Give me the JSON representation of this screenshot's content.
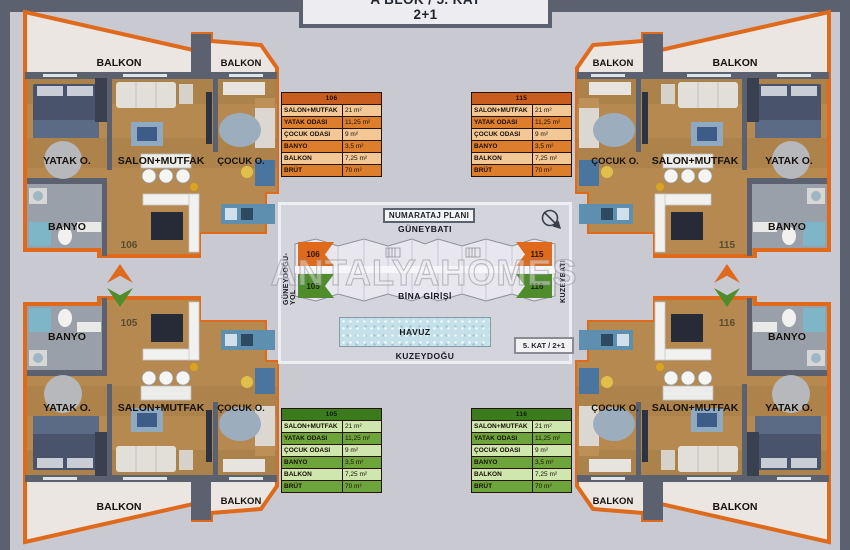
{
  "header": {
    "title_line1": "A BLOK / 5. KAT",
    "title_line2": "2+1"
  },
  "watermark": "ANTALYAHOMES",
  "colors": {
    "orange": "#E06A1C",
    "green": "#4F8D2C",
    "slate": "#5C6170",
    "pool_blue": "#C4E1E9"
  },
  "site_plan": {
    "title": "NUMARATAJ PLANI",
    "dir_top": "GÜNEYBATI",
    "dir_bottom": "KUZEYDOĞU",
    "dir_left": "GÜNEYDOĞU-YOL",
    "dir_right": "KUZEYBATI",
    "entrance": "BİNA GİRİŞİ",
    "pool": "HAVUZ",
    "floor_badge": "5. KAT / 2+1",
    "units": {
      "tl": "106",
      "bl": "105",
      "tr": "115",
      "br": "116"
    }
  },
  "apartments": {
    "a106": {
      "number": "106",
      "balkon_wide": "BALKON",
      "balkon_small": "BALKON",
      "bedroom": "YATAK O.",
      "living": "SALON+MUTFAK",
      "kids": "ÇOCUK O.",
      "bath": "BANYO"
    },
    "a115": {
      "number": "115",
      "balkon_wide": "BALKON",
      "balkon_small": "BALKON",
      "bedroom": "YATAK O.",
      "living": "SALON+MUTFAK",
      "kids": "ÇOCUK O.",
      "bath": "BANYO"
    },
    "a105": {
      "number": "105",
      "balkon_wide": "BALKON",
      "balkon_small": "BALKON",
      "bedroom": "YATAK O.",
      "living": "SALON+MUTFAK",
      "kids": "ÇOCUK O.",
      "bath": "BANYO"
    },
    "a116": {
      "number": "116",
      "balkon_wide": "BALKON",
      "balkon_small": "BALKON",
      "bedroom": "YATAK O.",
      "living": "SALON+MUTFAK",
      "kids": "ÇOCUK O.",
      "bath": "BANYO"
    }
  },
  "unit_tables": {
    "u106": {
      "unit": "106",
      "rows": [
        {
          "label": "SALON+MUTFAK",
          "value": "21 m²"
        },
        {
          "label": "YATAK ODASI",
          "value": "11,25 m²"
        },
        {
          "label": "ÇOCUK ODASI",
          "value": "9 m²"
        },
        {
          "label": "BANYO",
          "value": "3,5 m²"
        },
        {
          "label": "BALKON",
          "value": "7,25 m²"
        },
        {
          "label": "BRÜT",
          "value": "70 m²"
        }
      ]
    },
    "u115": {
      "unit": "115",
      "rows": [
        {
          "label": "SALON+MUTFAK",
          "value": "21 m²"
        },
        {
          "label": "YATAK ODASI",
          "value": "11,25 m²"
        },
        {
          "label": "ÇOCUK ODASI",
          "value": "9 m²"
        },
        {
          "label": "BANYO",
          "value": "3,5 m²"
        },
        {
          "label": "BALKON",
          "value": "7,25 m²"
        },
        {
          "label": "BRÜT",
          "value": "70 m²"
        }
      ]
    },
    "u105": {
      "unit": "105",
      "rows": [
        {
          "label": "SALON+MUTFAK",
          "value": "21 m²"
        },
        {
          "label": "YATAK ODASI",
          "value": "11,25 m²"
        },
        {
          "label": "ÇOCUK ODASI",
          "value": "9 m²"
        },
        {
          "label": "BANYO",
          "value": "3,5 m²"
        },
        {
          "label": "BALKON",
          "value": "7,25 m²"
        },
        {
          "label": "BRÜT",
          "value": "70 m²"
        }
      ]
    },
    "u116": {
      "unit": "116",
      "rows": [
        {
          "label": "SALON+MUTFAK",
          "value": "21 m²"
        },
        {
          "label": "YATAK ODASI",
          "value": "11,25 m²"
        },
        {
          "label": "ÇOCUK ODASI",
          "value": "9 m²"
        },
        {
          "label": "BANYO",
          "value": "3,5 m²"
        },
        {
          "label": "BALKON",
          "value": "7,25 m²"
        },
        {
          "label": "BRÜT",
          "value": "70 m²"
        }
      ]
    }
  }
}
